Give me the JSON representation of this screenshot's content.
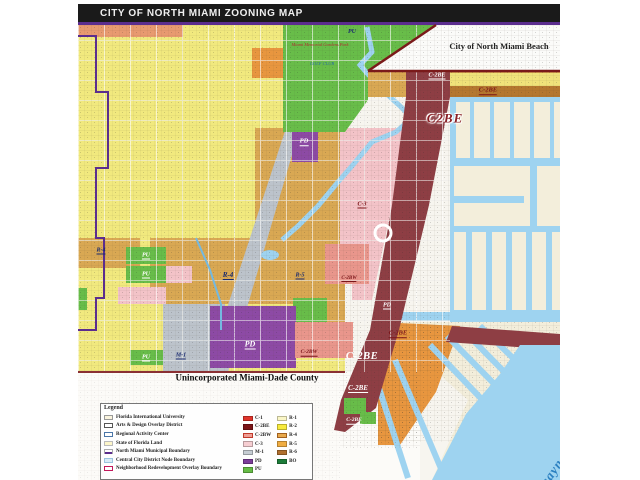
{
  "title": "CITY OF NORTH MIAMI ZOONING MAP",
  "legend": {
    "title": "Legend",
    "area_items": [
      {
        "label": "Florida International University",
        "swatch": "fiu"
      },
      {
        "label": "Arts & Design Overlay District",
        "swatch": "arts"
      },
      {
        "label": "Regional Activity Center",
        "swatch": "rac"
      },
      {
        "label": "State of Florida Land",
        "swatch": "state"
      },
      {
        "label": "North Miami Municipal Boundary",
        "swatch": "municipal"
      },
      {
        "label": "Central City District Node Boundary",
        "swatch": "node"
      },
      {
        "label": "Neighborhood Redevelopment Overlay Boundary",
        "swatch": "nro"
      }
    ],
    "zone_items_col1": [
      {
        "code": "C-1",
        "color": "#e0342b"
      },
      {
        "code": "C-2BE",
        "color": "#7c1518"
      },
      {
        "code": "C-2BW",
        "color": "#ef9e94",
        "border": "#c0392b"
      },
      {
        "code": "C-3",
        "color": "#f6ced2"
      },
      {
        "code": "M-1",
        "color": "#c6cdd3"
      },
      {
        "code": "PD",
        "color": "#7c3d9a"
      },
      {
        "code": "PU",
        "color": "#66bc46"
      }
    ],
    "zone_items_col2": [
      {
        "code": "R-1",
        "color": "#faf6c6"
      },
      {
        "code": "R-2",
        "color": "#f7ea3c"
      },
      {
        "code": "R-4",
        "color": "#e8a94c",
        "border": "#a06020"
      },
      {
        "code": "R-5",
        "color": "#f0ad42"
      },
      {
        "code": "R-6",
        "color": "#b06f2e"
      },
      {
        "code": "BO",
        "color": "#1c7c39"
      }
    ]
  },
  "map": {
    "colors": {
      "base": "#f7f5ef",
      "faint": "#fcfbf8",
      "r2": "#f1e97e",
      "r4": "#d9a853",
      "r4deep": "#e8963f",
      "r1": "#f3eedb",
      "c3": "#f3c3c8",
      "c2bw": "#e9968c",
      "c2be": "#8e3e44",
      "pd": "#8d4aa5",
      "pu": "#68bd49",
      "m1": "#bcc3cb",
      "water": "#9ed3f0",
      "salmon": "#e89a70",
      "brown": "#b5772f",
      "yellowStrip": "#f0e27a",
      "nmb": "#fbfbf9",
      "municipal": "#5b2d8e",
      "node": "#74b9e0",
      "nmbLine": "#7a1a1a",
      "countyLine": "#8a3033",
      "circle": "#ffffff"
    },
    "labels": [
      {
        "text": "PU",
        "x": 352,
        "y": 32,
        "cls": "lbl-navy",
        "size": 6
      },
      {
        "text": "Miami Memorial Gardens Park",
        "x": 320,
        "y": 45,
        "cls": "lbl-red",
        "size": 4.5
      },
      {
        "text": "GOLF CLUB",
        "x": 322,
        "y": 64,
        "cls": "lbl-blue",
        "size": 4.5
      },
      {
        "text": "City of North Miami Beach",
        "x": 499,
        "y": 46,
        "cls": "lbl-city",
        "size": 8.5
      },
      {
        "text": "C-2BE",
        "x": 437,
        "y": 76,
        "cls": "lbl-white-u",
        "size": 6
      },
      {
        "text": "C-2BE",
        "x": 488,
        "y": 91,
        "cls": "lbl-maroon-u",
        "size": 6.5
      },
      {
        "text": "C2BE",
        "x": 445,
        "y": 118,
        "cls": "lbl-big-maroon",
        "size": 13
      },
      {
        "text": "PD",
        "x": 304,
        "y": 142,
        "cls": "lbl-white-u",
        "size": 6.5
      },
      {
        "text": "C-3",
        "x": 362,
        "y": 205,
        "cls": "lbl-maroon-u",
        "size": 6
      },
      {
        "text": "R-4",
        "x": 101,
        "y": 251,
        "cls": "lbl-navy-u",
        "size": 6
      },
      {
        "text": "R-4",
        "x": 228,
        "y": 276,
        "cls": "lbl-navy-u",
        "size": 7
      },
      {
        "text": "R-5",
        "x": 300,
        "y": 276,
        "cls": "lbl-navy-u",
        "size": 6
      },
      {
        "text": "PU",
        "x": 146,
        "y": 256,
        "cls": "lbl-white-u",
        "size": 6
      },
      {
        "text": "PU",
        "x": 146,
        "y": 275,
        "cls": "lbl-white-u",
        "size": 6
      },
      {
        "text": "M-1",
        "x": 181,
        "y": 356,
        "cls": "lbl-navy-u",
        "size": 6
      },
      {
        "text": "PU",
        "x": 146,
        "y": 358,
        "cls": "lbl-white-u",
        "size": 6
      },
      {
        "text": "PD",
        "x": 250,
        "y": 345,
        "cls": "lbl-white-u",
        "size": 8
      },
      {
        "text": "PD",
        "x": 387,
        "y": 306,
        "cls": "lbl-white-u",
        "size": 6
      },
      {
        "text": "C-2BW",
        "x": 309,
        "y": 353,
        "cls": "lbl-maroon-u",
        "size": 5.5
      },
      {
        "text": "C-2BW",
        "x": 349,
        "y": 279,
        "cls": "lbl-maroon-u",
        "size": 5
      },
      {
        "text": "C-2BE",
        "x": 362,
        "y": 357,
        "cls": "lbl-big-white",
        "size": 10.5
      },
      {
        "text": "C-2BE",
        "x": 358,
        "y": 389,
        "cls": "lbl-white-u",
        "size": 7
      },
      {
        "text": "C-2BE",
        "x": 398,
        "y": 334,
        "cls": "lbl-maroon-u",
        "size": 6.5
      },
      {
        "text": "C-2BE",
        "x": 354,
        "y": 421,
        "cls": "lbl-white-u",
        "size": 5.5
      },
      {
        "text": "Unincorporated Miami-Dade County",
        "x": 247,
        "y": 378,
        "cls": "lbl-county",
        "size": 9
      },
      {
        "text": "Biscayne Bay",
        "x": 556,
        "y": 466,
        "cls": "lbl-bay",
        "size": 13,
        "rot": -55
      }
    ]
  }
}
